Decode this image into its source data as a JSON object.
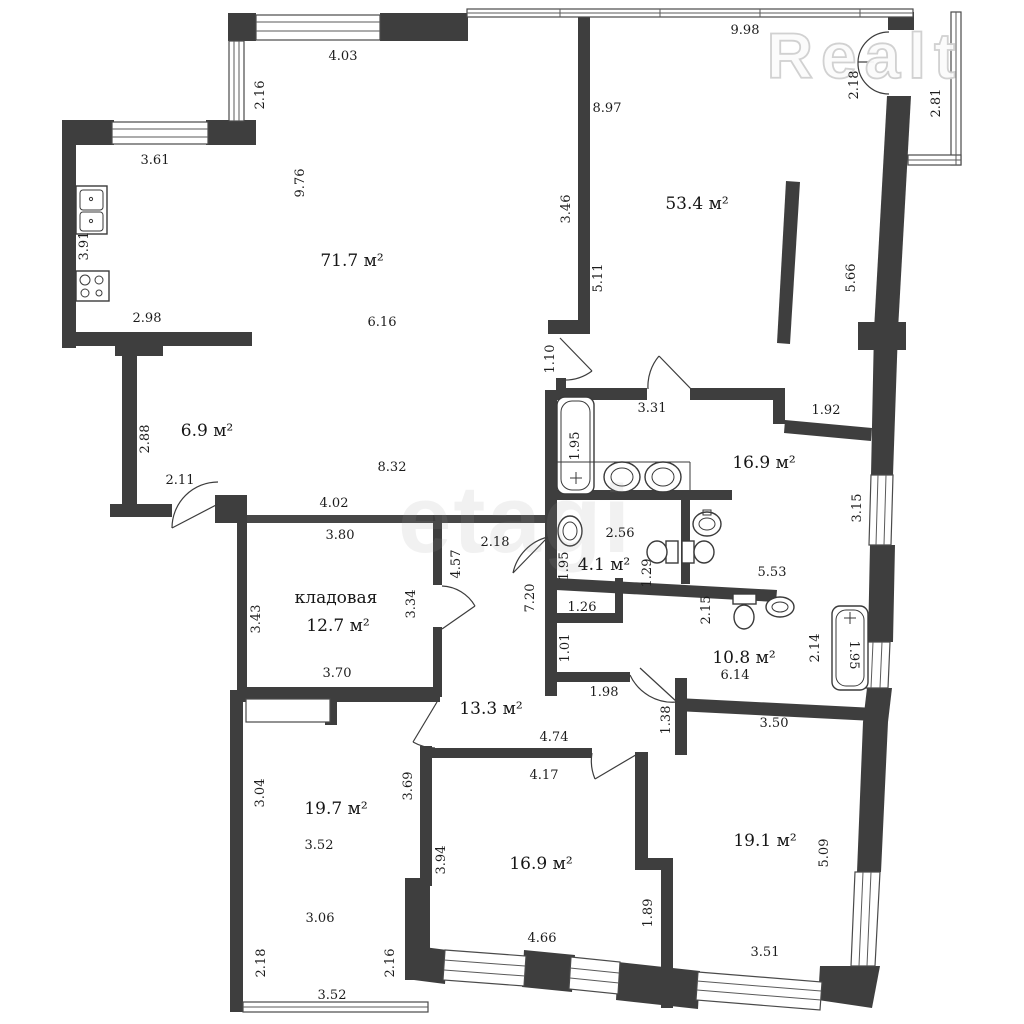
{
  "watermarks": {
    "realt": "Realt",
    "etagi": "etagi"
  },
  "rooms": [
    {
      "text": "71.7 м²",
      "x": 352,
      "y": 266,
      "rot": 0
    },
    {
      "text": "53.4 м²",
      "x": 697,
      "y": 209,
      "rot": 0
    },
    {
      "text": "6.9 м²",
      "x": 207,
      "y": 436,
      "rot": 0
    },
    {
      "text": "16.9 м²",
      "x": 764,
      "y": 468,
      "rot": 0
    },
    {
      "text": "4.1 м²",
      "x": 604,
      "y": 570,
      "rot": 0
    },
    {
      "text": "кладовая",
      "x": 336,
      "y": 603,
      "rot": 0
    },
    {
      "text": "12.7 м²",
      "x": 338,
      "y": 631,
      "rot": 0
    },
    {
      "text": "10.8 м²",
      "x": 744,
      "y": 663,
      "rot": 0
    },
    {
      "text": "13.3 м²",
      "x": 491,
      "y": 714,
      "rot": 0
    },
    {
      "text": "19.7 м²",
      "x": 336,
      "y": 814,
      "rot": 0
    },
    {
      "text": "16.9 м²",
      "x": 541,
      "y": 869,
      "rot": 0
    },
    {
      "text": "19.1 м²",
      "x": 765,
      "y": 846,
      "rot": 0
    }
  ],
  "dimensions": [
    {
      "text": "4.03",
      "x": 343,
      "y": 60,
      "rot": 0
    },
    {
      "text": "2.16",
      "x": 264,
      "y": 95,
      "rot": -90
    },
    {
      "text": "9.98",
      "x": 745,
      "y": 34,
      "rot": 0
    },
    {
      "text": "2.18",
      "x": 858,
      "y": 85,
      "rot": -90
    },
    {
      "text": "2.81",
      "x": 940,
      "y": 103,
      "rot": -90
    },
    {
      "text": "3.61",
      "x": 155,
      "y": 164,
      "rot": 0
    },
    {
      "text": "8.97",
      "x": 607,
      "y": 112,
      "rot": 0
    },
    {
      "text": "9.76",
      "x": 304,
      "y": 183,
      "rot": -90
    },
    {
      "text": "3.46",
      "x": 570,
      "y": 209,
      "rot": -90
    },
    {
      "text": "5.11",
      "x": 602,
      "y": 278,
      "rot": -90
    },
    {
      "text": "5.66",
      "x": 855,
      "y": 278,
      "rot": -90
    },
    {
      "text": "3.91",
      "x": 88,
      "y": 246,
      "rot": -90
    },
    {
      "text": "2.98",
      "x": 147,
      "y": 322,
      "rot": 0
    },
    {
      "text": "6.16",
      "x": 382,
      "y": 326,
      "rot": 0
    },
    {
      "text": "1.10",
      "x": 554,
      "y": 359,
      "rot": -90
    },
    {
      "text": "2.88",
      "x": 149,
      "y": 439,
      "rot": -90
    },
    {
      "text": "2.11",
      "x": 180,
      "y": 484,
      "rot": 0
    },
    {
      "text": "8.32",
      "x": 392,
      "y": 471,
      "rot": 0
    },
    {
      "text": "4.02",
      "x": 334,
      "y": 507,
      "rot": 0
    },
    {
      "text": "3.80",
      "x": 340,
      "y": 539,
      "rot": 0
    },
    {
      "text": "3.31",
      "x": 652,
      "y": 412,
      "rot": 0
    },
    {
      "text": "1.92",
      "x": 826,
      "y": 414,
      "rot": 0
    },
    {
      "text": "1.95",
      "x": 579,
      "y": 446,
      "rot": -90
    },
    {
      "text": "3.15",
      "x": 861,
      "y": 508,
      "rot": -90
    },
    {
      "text": "2.18",
      "x": 495,
      "y": 546,
      "rot": 0
    },
    {
      "text": "2.56",
      "x": 620,
      "y": 537,
      "rot": 0
    },
    {
      "text": "4.57",
      "x": 460,
      "y": 564,
      "rot": -90
    },
    {
      "text": "3.34",
      "x": 415,
      "y": 604,
      "rot": -90
    },
    {
      "text": "1.95",
      "x": 568,
      "y": 566,
      "rot": -90
    },
    {
      "text": "1.29",
      "x": 651,
      "y": 573,
      "rot": -90
    },
    {
      "text": "5.53",
      "x": 772,
      "y": 576,
      "rot": 0
    },
    {
      "text": "3.43",
      "x": 260,
      "y": 619,
      "rot": -90
    },
    {
      "text": "2.15",
      "x": 710,
      "y": 610,
      "rot": -90
    },
    {
      "text": "1.26",
      "x": 582,
      "y": 611,
      "rot": 0
    },
    {
      "text": "7.20",
      "x": 534,
      "y": 598,
      "rot": -90
    },
    {
      "text": "1.01",
      "x": 569,
      "y": 648,
      "rot": -90
    },
    {
      "text": "6.14",
      "x": 735,
      "y": 679,
      "rot": 0
    },
    {
      "text": "2.14",
      "x": 819,
      "y": 648,
      "rot": -90
    },
    {
      "text": "1.95",
      "x": 850,
      "y": 655,
      "rot": 90
    },
    {
      "text": "3.70",
      "x": 337,
      "y": 677,
      "rot": 0
    },
    {
      "text": "1.98",
      "x": 604,
      "y": 696,
      "rot": 0
    },
    {
      "text": "1.38",
      "x": 670,
      "y": 720,
      "rot": -90
    },
    {
      "text": "3.50",
      "x": 774,
      "y": 727,
      "rot": 0
    },
    {
      "text": "3.04",
      "x": 264,
      "y": 793,
      "rot": -90
    },
    {
      "text": "4.74",
      "x": 554,
      "y": 741,
      "rot": 0
    },
    {
      "text": "3.69",
      "x": 412,
      "y": 786,
      "rot": -90
    },
    {
      "text": "4.17",
      "x": 544,
      "y": 779,
      "rot": 0
    },
    {
      "text": "3.52",
      "x": 319,
      "y": 849,
      "rot": 0
    },
    {
      "text": "3.94",
      "x": 445,
      "y": 860,
      "rot": -90
    },
    {
      "text": "5.09",
      "x": 828,
      "y": 853,
      "rot": -90
    },
    {
      "text": "1.89",
      "x": 652,
      "y": 913,
      "rot": -90
    },
    {
      "text": "3.06",
      "x": 320,
      "y": 922,
      "rot": 0
    },
    {
      "text": "4.66",
      "x": 542,
      "y": 942,
      "rot": 0
    },
    {
      "text": "2.18",
      "x": 265,
      "y": 963,
      "rot": -90
    },
    {
      "text": "2.16",
      "x": 394,
      "y": 963,
      "rot": -90
    },
    {
      "text": "3.52",
      "x": 332,
      "y": 999,
      "rot": 0
    },
    {
      "text": "3.51",
      "x": 765,
      "y": 956,
      "rot": 0
    }
  ]
}
